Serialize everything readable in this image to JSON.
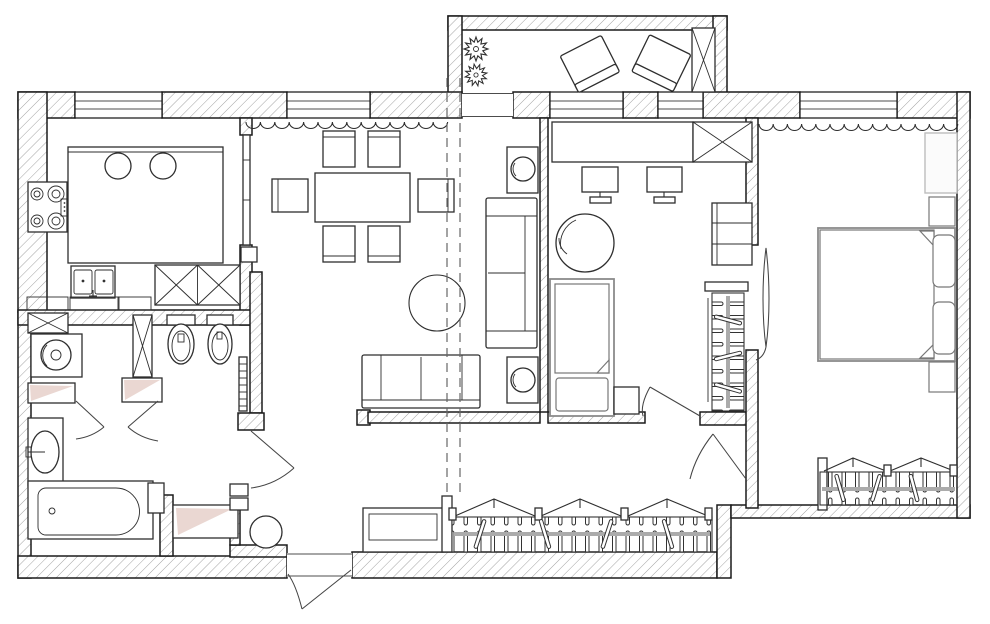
{
  "meta": {
    "title": "Two-bedroom apartment furniture floor plan, top view",
    "drawing_style": "black line work with hatched walls on white",
    "canvas": {
      "width": 990,
      "height": 624
    }
  },
  "colors": {
    "background": "#ffffff",
    "wall_line": "#1b1b1b",
    "hatch": "#a3a3a3",
    "furniture_line": "#2e2e2e",
    "furniture_gray": "#8a8a8a",
    "accent_pink": "#ead7d2",
    "dashed_line": "#666666"
  },
  "rooms": [
    {
      "id": "balcony",
      "label": "Balcony",
      "furniture": [
        "two plants",
        "two rotated armchairs",
        "x-marked cabinet"
      ]
    },
    {
      "id": "kitchen",
      "label": "Kitchen",
      "furniture": [
        "island with two round sinks",
        "four-burner cooktop",
        "double sink with faucet",
        "base cabinets",
        "two x-marked cabinets"
      ]
    },
    {
      "id": "bathroom",
      "label": "Bathroom and WC",
      "furniture": [
        "washing machine",
        "x-marked cabinet",
        "tall x-marked column",
        "toilet",
        "bidet",
        "towel radiator",
        "oval washbasin on vanity",
        "bathtub",
        "two radiator niches"
      ]
    },
    {
      "id": "living-room",
      "label": "Living / dining room",
      "furniture": [
        "dining table",
        "six chairs",
        "three-seat sofa",
        "two-seat sofa",
        "two side tables with lamps",
        "round rug",
        "window curtain",
        "dismantled-wall dashed lines"
      ]
    },
    {
      "id": "office",
      "label": "Office / kids room",
      "furniture": [
        "desk",
        "two monitors",
        "x-marked cabinet",
        "hanging chair",
        "single bed with pillow",
        "nightstand",
        "shelving unit",
        "wardrobe with hangers"
      ]
    },
    {
      "id": "bedroom",
      "label": "Bedroom",
      "furniture": [
        "double bed with two pillows",
        "two nightstands",
        "dresser",
        "wardrobe with hangers",
        "window curtain"
      ]
    },
    {
      "id": "hallway",
      "label": "Hallway",
      "furniture": [
        "three-section wardrobe with hangers",
        "bench",
        "round pouf",
        "shoe cabinet",
        "entry door"
      ]
    }
  ],
  "openings": {
    "windows": 5,
    "balcony_door": 1,
    "entry_door": 1,
    "interior_doors": 6
  }
}
